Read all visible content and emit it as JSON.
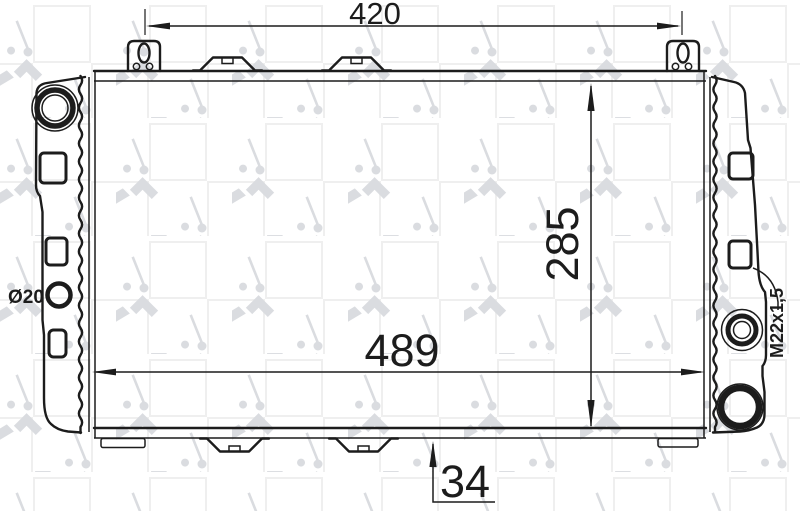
{
  "drawing": {
    "title": "radiator-technical-drawing",
    "brand_watermark": "NRF",
    "dimensions": {
      "bracket_span": "420",
      "core_height": "285",
      "core_width": "489",
      "bottom_offset": "34",
      "inlet_diameter": "Ø20",
      "thread_spec": "M22x1,5"
    },
    "colors": {
      "line": "#1c1c1c",
      "watermark_logo": "#dadce0",
      "watermark_square": "#efefef",
      "background": "#ffffff"
    }
  }
}
